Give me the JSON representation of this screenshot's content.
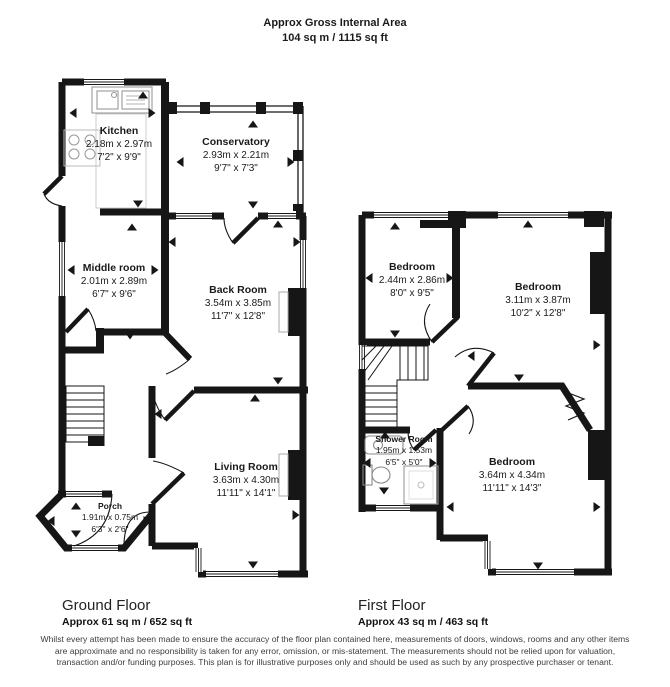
{
  "header": {
    "title": "Approx Gross Internal Area",
    "subtitle": "104 sq m / 1115 sq ft"
  },
  "ground_floor": {
    "label": "Ground Floor",
    "area": "Approx 61 sq m / 652 sq ft",
    "rooms": [
      {
        "name": "Kitchen",
        "metric": "2.18m x 2.97m",
        "imperial": "7'2\" x 9'9\""
      },
      {
        "name": "Conservatory",
        "metric": "2.93m x 2.21m",
        "imperial": "9'7\" x 7'3\""
      },
      {
        "name": "Middle room",
        "metric": "2.01m x 2.89m",
        "imperial": "6'7\" x 9'6\""
      },
      {
        "name": "Back Room",
        "metric": "3.54m x 3.85m",
        "imperial": "11'7\" x 12'8\""
      },
      {
        "name": "Living Room",
        "metric": "3.63m x 4.30m",
        "imperial": "11'11\" x 14'1\""
      },
      {
        "name": "Porch",
        "metric": "1.91m x 0.75m",
        "imperial": "6'3\" x 2'6\""
      }
    ]
  },
  "first_floor": {
    "label": "First Floor",
    "area": "Approx 43 sq m / 463 sq ft",
    "rooms": [
      {
        "name": "Bedroom",
        "metric": "2.44m x 2.86m",
        "imperial": "8'0\" x 9'5\""
      },
      {
        "name": "Bedroom",
        "metric": "3.11m x 3.87m",
        "imperial": "10'2\" x 12'8\""
      },
      {
        "name": "Shower Room",
        "metric": "1.95m x 1.53m",
        "imperial": "6'5\" x 5'0\""
      },
      {
        "name": "Bedroom",
        "metric": "3.64m x 4.34m",
        "imperial": "11'11\" x 14'3\""
      }
    ]
  },
  "disclaimer": "Whilst every attempt has been made to ensure the accuracy of the floor plan contained here, measurements of doors, windows, rooms and any other items are approximate and no responsibility is taken for any error, omission, or mis-statement. The measurements should not be relied upon for valuation, transaction and/or funding purposes. This plan is for illustrative purposes only and should be used as such by any prospective purchaser or tenant.",
  "colors": {
    "wall": "#161616",
    "background": "#ffffff",
    "fixture_outline": "#999999",
    "text": "#1a1a1a"
  }
}
